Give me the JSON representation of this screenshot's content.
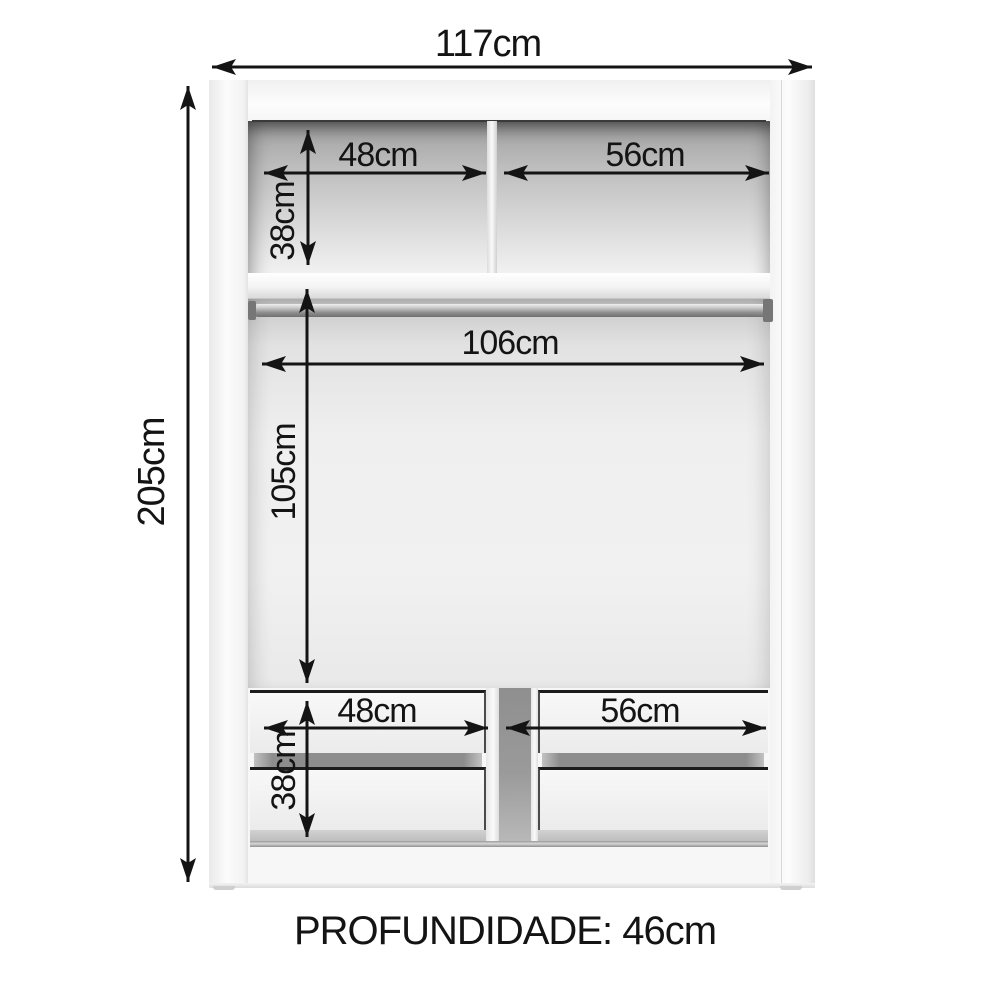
{
  "diagram": {
    "depth_label": "PROFUNDIDADE: 46cm",
    "dimensions": {
      "overall_width": "117cm",
      "overall_height": "205cm",
      "top_shelf_left_width": "48cm",
      "top_shelf_right_width": "56cm",
      "top_shelf_height": "38cm",
      "hanging_rod_width": "106cm",
      "hanging_area_height": "105cm",
      "drawers_left_width": "48cm",
      "drawers_right_width": "56cm",
      "drawers_height": "38cm"
    },
    "colors": {
      "background": "#ffffff",
      "arrow": "#141414",
      "label_text": "#141414",
      "cabinet_white": "#f7f7f7",
      "interior_shadow_gray": "#9f9f9f",
      "divider_recess_gray": "#8f8f8f"
    }
  }
}
